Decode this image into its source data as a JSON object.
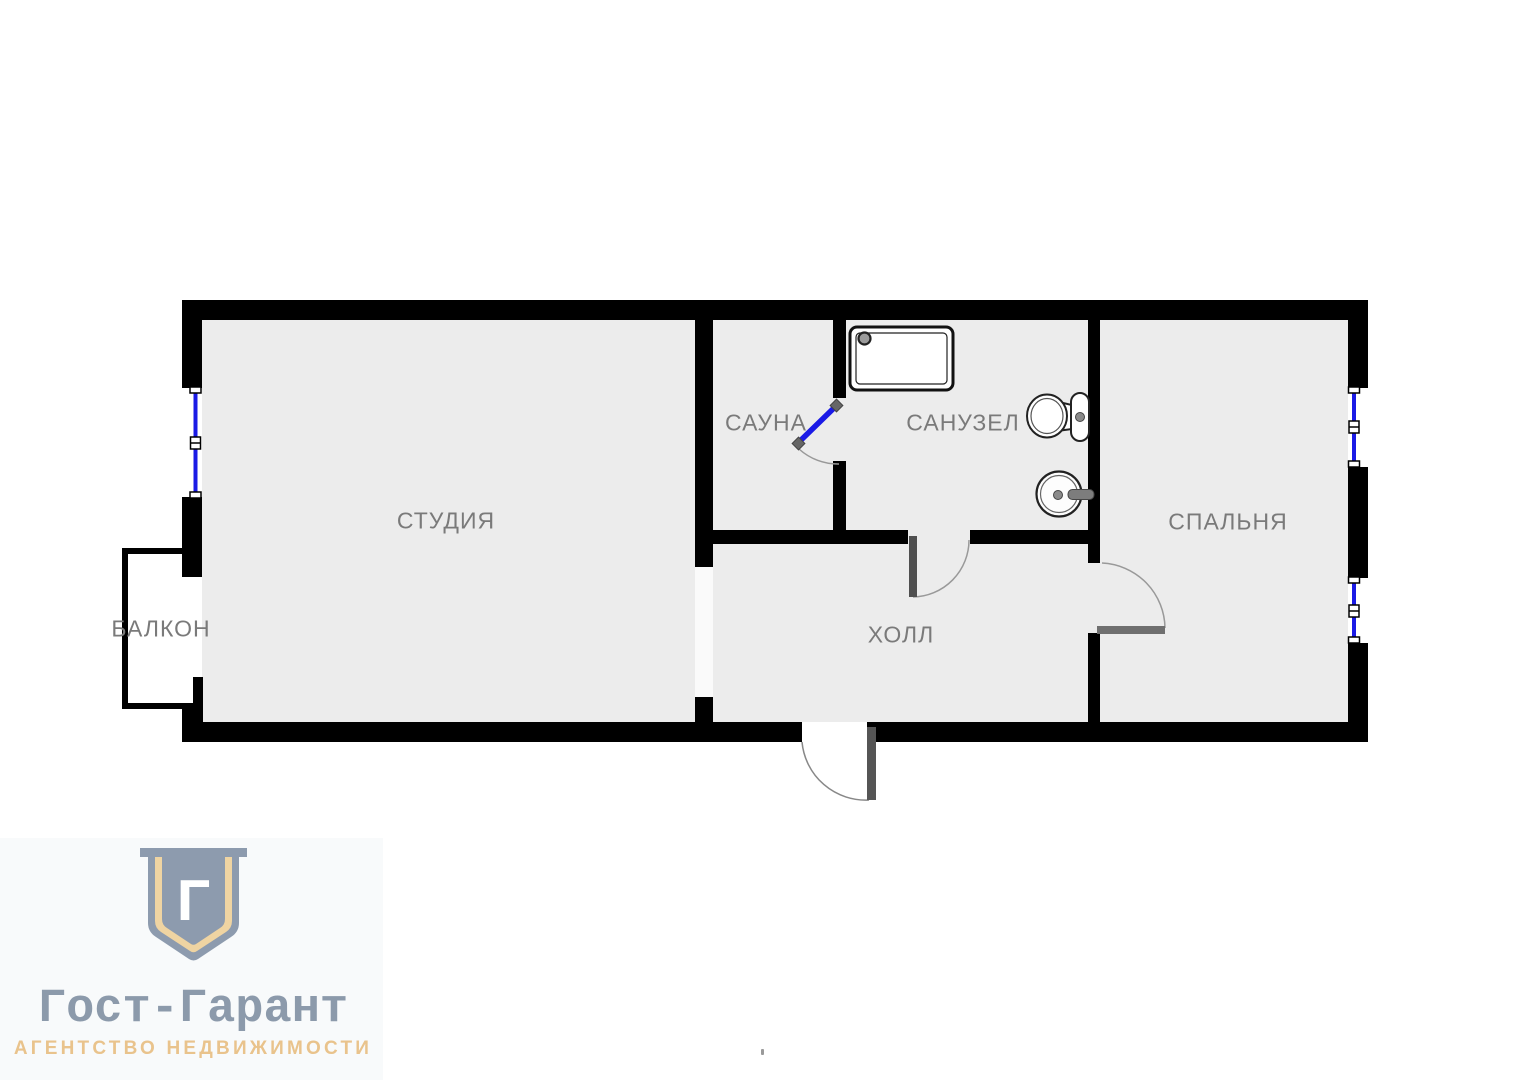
{
  "plan": {
    "rooms": [
      {
        "id": "studio",
        "label": "СТУДИЯ"
      },
      {
        "id": "sauna",
        "label": "САУНА"
      },
      {
        "id": "bathroom",
        "label": "САНУЗЕЛ"
      },
      {
        "id": "bedroom",
        "label": "СПАЛЬНЯ"
      },
      {
        "id": "hall",
        "label": "ХОЛЛ"
      },
      {
        "id": "balcony",
        "label": "БАЛКОН"
      }
    ],
    "colors": {
      "wall": "#000000",
      "floor": "#ececec",
      "window_blue": "#1a1ae6",
      "door_leaf_gray": "#555555",
      "label_gray": "#7a7a7a"
    },
    "fixture_icons": [
      "shower-tray-icon",
      "toilet-icon",
      "sink-icon",
      "window-icon",
      "door-swing-icon"
    ]
  },
  "logo": {
    "monogram": "Г",
    "title": "Гост-Гарант",
    "subtitle": "АГЕНТСТВО НЕДВИЖИМОСТИ",
    "shield_color": "#8d9bae",
    "gold_color": "#efd4a2"
  }
}
